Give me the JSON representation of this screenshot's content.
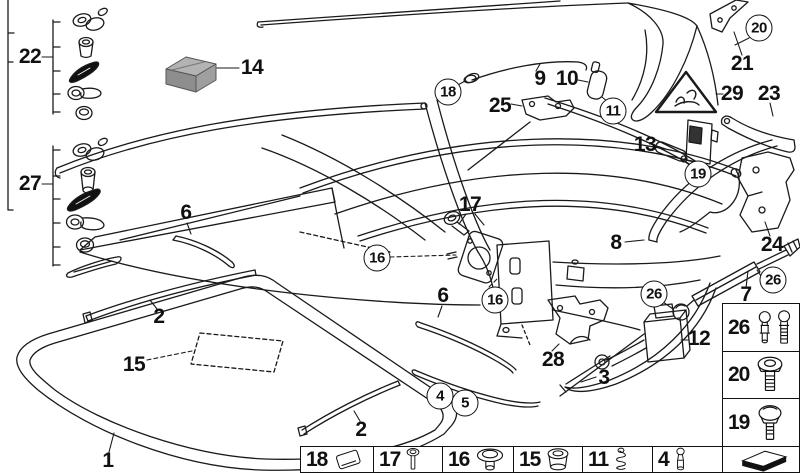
{
  "diagram_title": "Folding top parts diagram",
  "colors": {
    "line": "#1a1a1a",
    "background": "#ffffff",
    "dark_part": "#111111",
    "box_gray_top": "#b3b3b3",
    "box_gray_front": "#8e8e8e",
    "box_gray_side": "#9f9f9f"
  },
  "labels": [
    {
      "text": "22",
      "x": 30,
      "y": 57,
      "circled": false
    },
    {
      "text": "27",
      "x": 30,
      "y": 184,
      "circled": false
    },
    {
      "text": "14",
      "x": 252,
      "y": 68,
      "circled": false
    },
    {
      "text": "9",
      "x": 540,
      "y": 79,
      "circled": false
    },
    {
      "text": "10",
      "x": 567,
      "y": 79,
      "circled": false
    },
    {
      "text": "18",
      "x": 448,
      "y": 92,
      "circled": true
    },
    {
      "text": "25",
      "x": 500,
      "y": 106,
      "circled": false
    },
    {
      "text": "11",
      "x": 613,
      "y": 111,
      "circled": true
    },
    {
      "text": "13",
      "x": 645,
      "y": 145,
      "circled": false
    },
    {
      "text": "29",
      "x": 732,
      "y": 94,
      "circled": false
    },
    {
      "text": "23",
      "x": 769,
      "y": 94,
      "circled": false
    },
    {
      "text": "21",
      "x": 742,
      "y": 64,
      "circled": false
    },
    {
      "text": "20",
      "x": 759,
      "y": 28,
      "circled": true
    },
    {
      "text": "19",
      "x": 698,
      "y": 174,
      "circled": true
    },
    {
      "text": "24",
      "x": 772,
      "y": 245,
      "circled": false
    },
    {
      "text": "8",
      "x": 616,
      "y": 243,
      "circled": false
    },
    {
      "text": "17",
      "x": 470,
      "y": 205,
      "circled": false
    },
    {
      "text": "16",
      "x": 377,
      "y": 258,
      "circled": true
    },
    {
      "text": "16",
      "x": 495,
      "y": 300,
      "circled": true
    },
    {
      "text": "6",
      "x": 186,
      "y": 213,
      "circled": false
    },
    {
      "text": "6",
      "x": 443,
      "y": 296,
      "circled": false
    },
    {
      "text": "2",
      "x": 159,
      "y": 317,
      "circled": false
    },
    {
      "text": "2",
      "x": 361,
      "y": 430,
      "circled": false
    },
    {
      "text": "15",
      "x": 134,
      "y": 365,
      "circled": false
    },
    {
      "text": "1",
      "x": 108,
      "y": 461,
      "circled": false
    },
    {
      "text": "3",
      "x": 604,
      "y": 378,
      "circled": false
    },
    {
      "text": "28",
      "x": 553,
      "y": 360,
      "circled": false
    },
    {
      "text": "4",
      "x": 440,
      "y": 396,
      "circled": true
    },
    {
      "text": "5",
      "x": 465,
      "y": 403,
      "circled": true
    },
    {
      "text": "26",
      "x": 654,
      "y": 294,
      "circled": true
    },
    {
      "text": "26",
      "x": 773,
      "y": 280,
      "circled": true
    },
    {
      "text": "12",
      "x": 699,
      "y": 339,
      "circled": false
    },
    {
      "text": "7",
      "x": 746,
      "y": 295,
      "circled": false
    }
  ],
  "legend": {
    "bottom_row": [
      {
        "number": "18",
        "icon": "plate-icon"
      },
      {
        "number": "17",
        "icon": "socket-bolt-icon"
      },
      {
        "number": "16",
        "icon": "grommet-icon"
      },
      {
        "number": "15",
        "icon": "bushing-icon"
      },
      {
        "number": "11",
        "icon": "spring-icon"
      },
      {
        "number": "4",
        "icon": "pin-icon"
      },
      {
        "number": "",
        "icon": "direction-arrow-icon"
      }
    ],
    "right_column": [
      {
        "number": "26",
        "icon": "ball-studs-icon"
      },
      {
        "number": "20",
        "icon": "shoulder-bolt-icon"
      },
      {
        "number": "19",
        "icon": "dome-bolt-icon"
      }
    ]
  }
}
